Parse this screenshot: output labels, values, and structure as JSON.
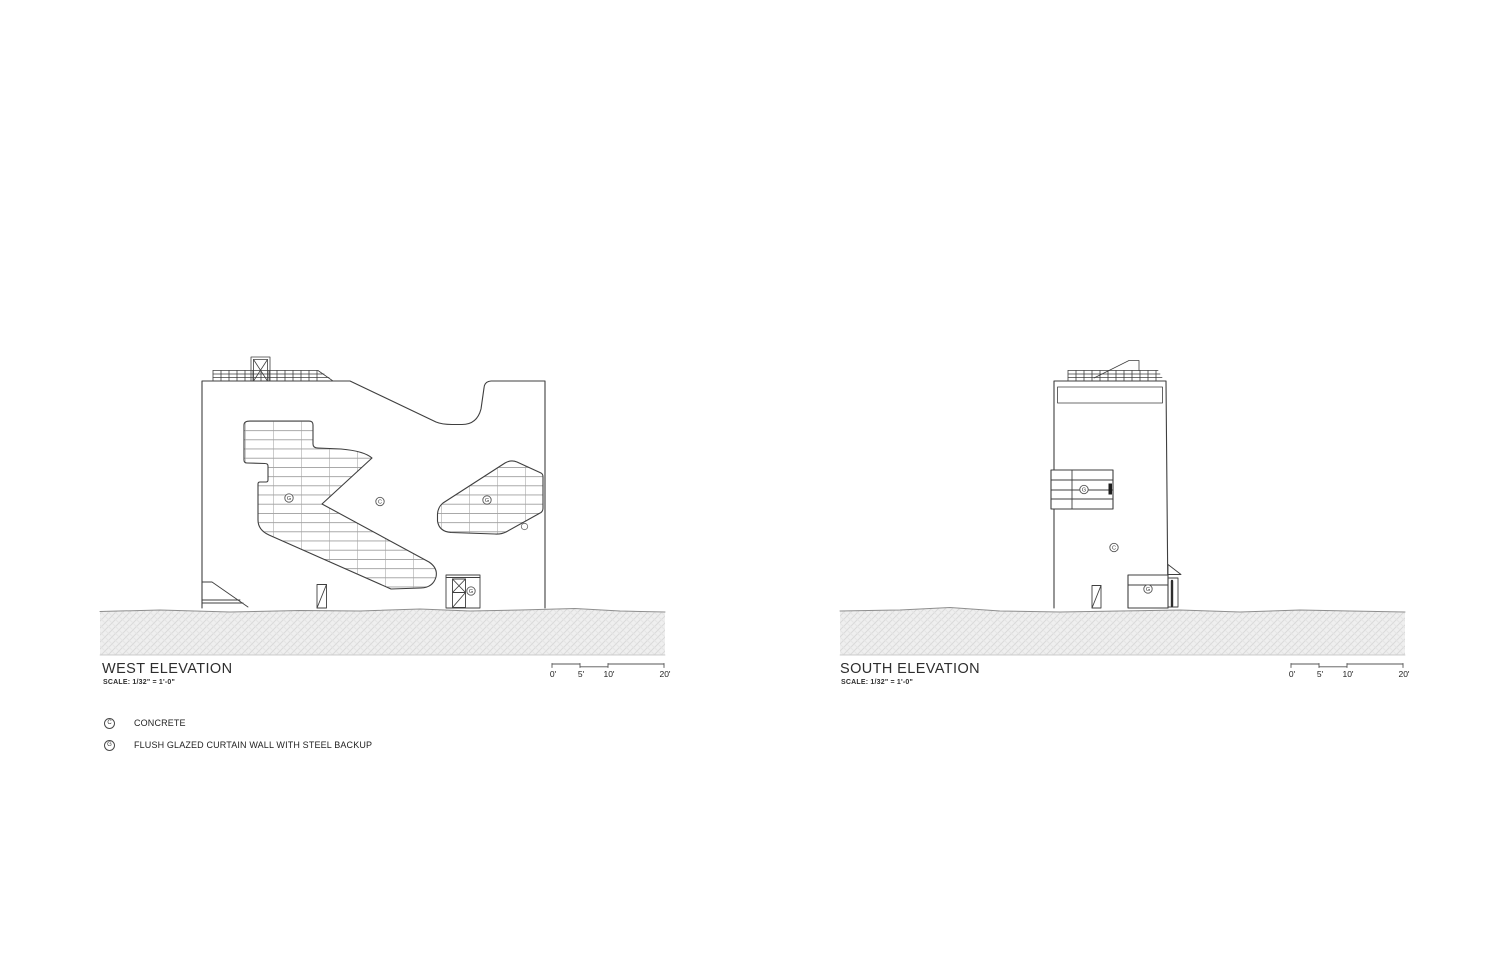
{
  "sheet": {
    "type_note": "architectural elevation sheet",
    "background": "#ffffff"
  },
  "colors": {
    "line": "#3f3f3f",
    "glazing_grid": "#8a8a8a",
    "ground_fill": "#efefef",
    "ground_hatch": "#dadada"
  },
  "west_elevation": {
    "title": "WEST ELEVATION",
    "scale_note": "SCALE: 1/32\" = 1'-0\"",
    "scale_bar": {
      "tick_labels": [
        "0'",
        "5'",
        "10'",
        "20'"
      ]
    },
    "material_tags": [
      {
        "letter": "G"
      },
      {
        "letter": "C"
      },
      {
        "letter": "G"
      },
      {
        "letter": "G"
      }
    ]
  },
  "south_elevation": {
    "title": "SOUTH ELEVATION",
    "scale_note": "SCALE: 1/32\" = 1'-0\"",
    "scale_bar": {
      "tick_labels": [
        "0'",
        "5'",
        "10'",
        "20'"
      ]
    },
    "material_tags": [
      {
        "letter": "G"
      },
      {
        "letter": "C"
      },
      {
        "letter": "G"
      }
    ]
  },
  "legend": {
    "items": [
      {
        "symbol": "C",
        "label": "CONCRETE"
      },
      {
        "symbol": "G",
        "label": "FLUSH GLAZED CURTAIN WALL WITH STEEL BACKUP"
      }
    ]
  }
}
